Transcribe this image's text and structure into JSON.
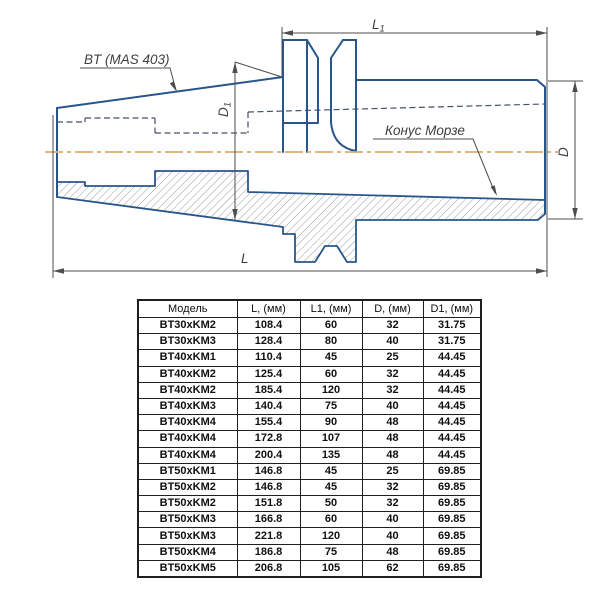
{
  "drawing": {
    "labels": {
      "standard": "BT (MAS 403)",
      "morse_taper": "Конус Морзе",
      "dim_L1_base": "L",
      "dim_L1_sub": "1",
      "dim_D1_base": "D",
      "dim_D1_sub": "1",
      "dim_D": "D",
      "dim_L": "L"
    },
    "colors": {
      "outline_blue": "#29568a",
      "hidden_line": "#44516b",
      "centerline_orange": "#ddad6e",
      "dimension_gray": "#4d4d4d",
      "hatch_gray": "#9b9b9b",
      "label_gray": "#3f3f3f"
    }
  },
  "table": {
    "headers": [
      "Модель",
      "L, (мм)",
      "L1, (мм)",
      "D, (мм)",
      "D1, (мм)"
    ],
    "col_widths": [
      99,
      63,
      62,
      61,
      58
    ],
    "rows": [
      [
        "BT30xKM2",
        "108.4",
        "60",
        "32",
        "31.75"
      ],
      [
        "BT30xKM3",
        "128.4",
        "80",
        "40",
        "31.75"
      ],
      [
        "BT40xKM1",
        "110.4",
        "45",
        "25",
        "44.45"
      ],
      [
        "BT40xKM2",
        "125.4",
        "60",
        "32",
        "44.45"
      ],
      [
        "BT40xKM2",
        "185.4",
        "120",
        "32",
        "44.45"
      ],
      [
        "BT40xKM3",
        "140.4",
        "75",
        "40",
        "44.45"
      ],
      [
        "BT40xKM4",
        "155.4",
        "90",
        "48",
        "44.45"
      ],
      [
        "BT40xKM4",
        "172.8",
        "107",
        "48",
        "44.45"
      ],
      [
        "BT40xKM4",
        "200.4",
        "135",
        "48",
        "44.45"
      ],
      [
        "BT50xKM1",
        "146.8",
        "45",
        "25",
        "69.85"
      ],
      [
        "BT50xKM2",
        "146.8",
        "45",
        "32",
        "69.85"
      ],
      [
        "BT50xKM2",
        "151.8",
        "50",
        "32",
        "69.85"
      ],
      [
        "BT50xKM3",
        "166.8",
        "60",
        "40",
        "69.85"
      ],
      [
        "BT50xKM3",
        "221.8",
        "120",
        "40",
        "69.85"
      ],
      [
        "BT50xKM4",
        "186.8",
        "75",
        "48",
        "69.85"
      ],
      [
        "BT50xKM5",
        "206.8",
        "105",
        "62",
        "69.85"
      ]
    ]
  }
}
